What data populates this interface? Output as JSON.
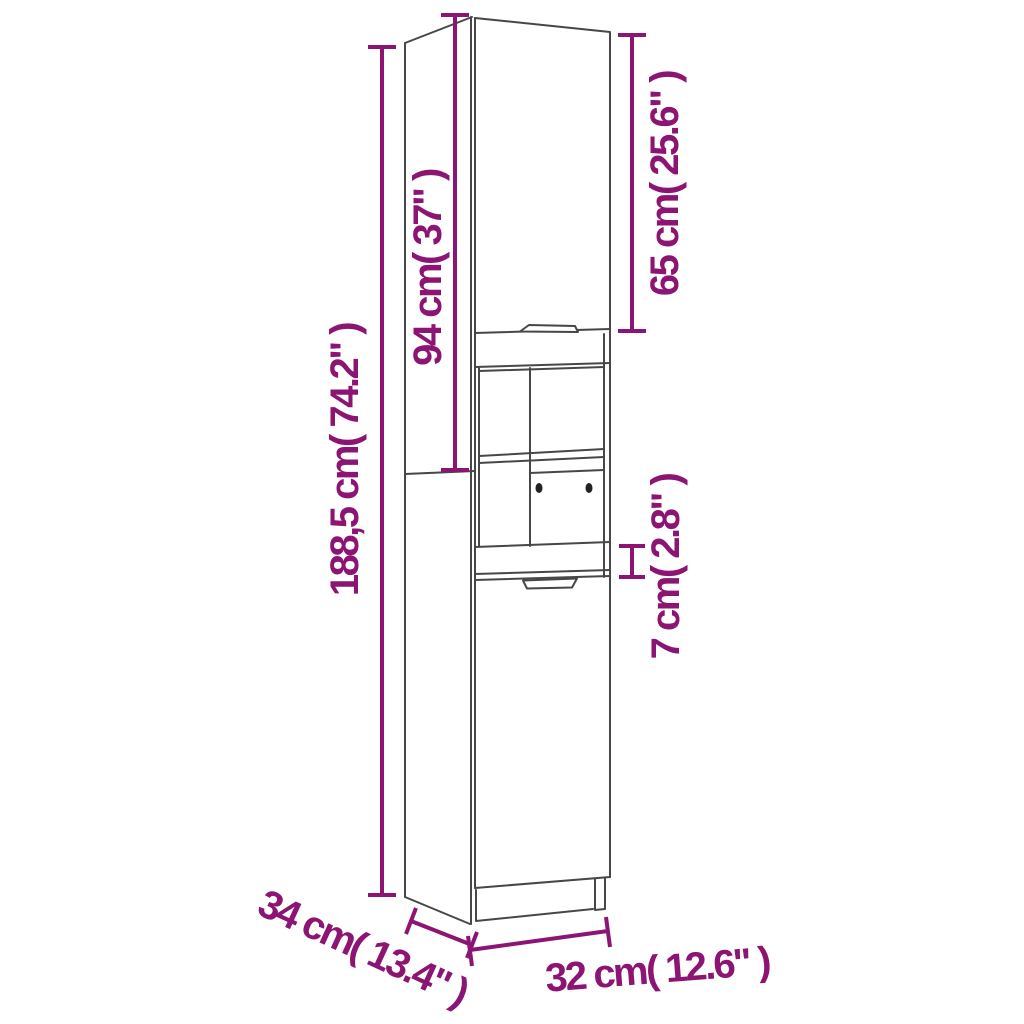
{
  "diagram": {
    "type": "product-dimension-diagram",
    "subject": "tall-cabinet-line-drawing",
    "background_color": "#ffffff",
    "drawing_line_color": "#474747",
    "dimension_color": "#8C1472",
    "dimensions": {
      "total_height": "188,5 cm( 74.2\" )",
      "upper_section_height": "94 cm( 37\" )",
      "top_door_height": "65 cm( 25.6\" )",
      "middle_panel_height": "7 cm( 2.8\" )",
      "depth": "34 cm( 13.4\" )",
      "width": "32 cm( 12.6\" )"
    }
  }
}
